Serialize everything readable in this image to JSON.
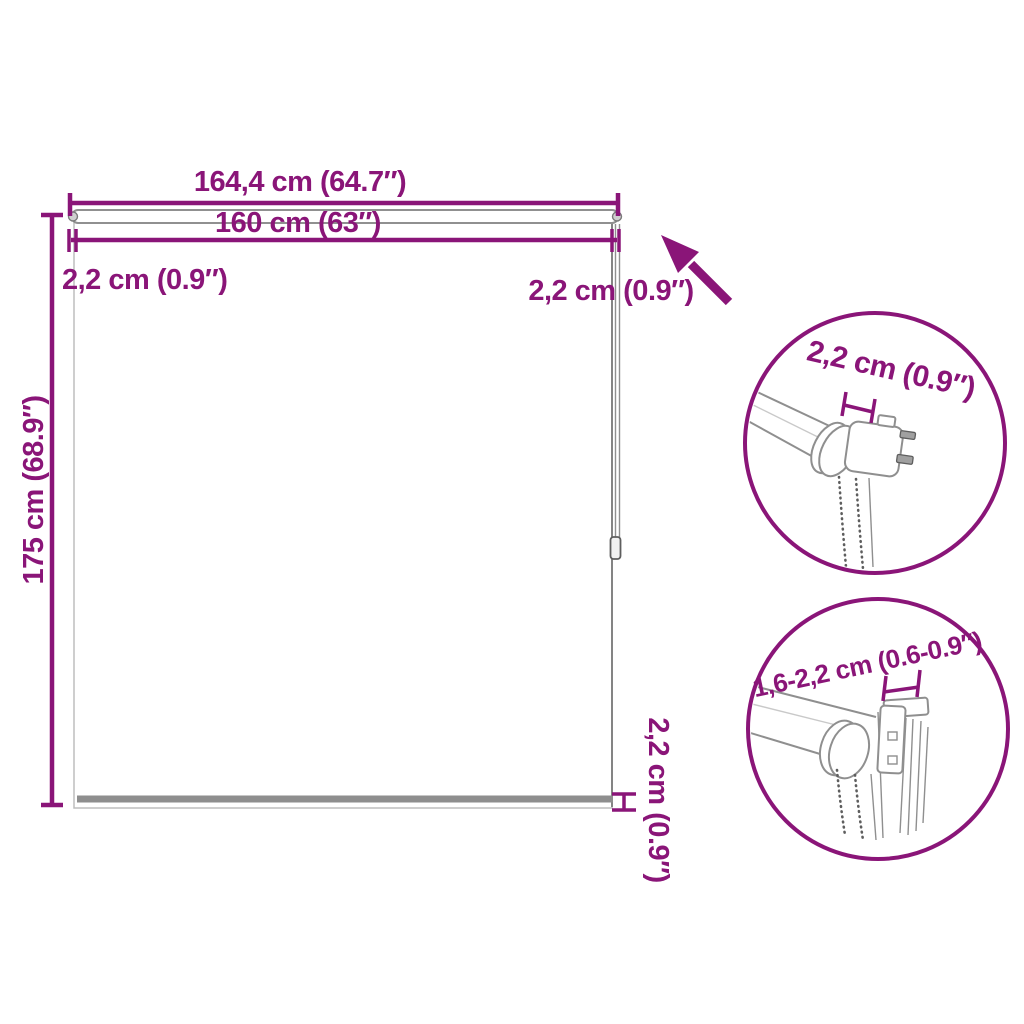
{
  "colors": {
    "accent": "#8A1578",
    "outline": "#8F8F8F",
    "outline_light": "#C9C9C9",
    "outline_dark": "#5E5E5E",
    "rail_fill": "#8E8E8E",
    "pin_fill": "#A0A0A0"
  },
  "labels": {
    "total_width": "164,4 cm (64.7″)",
    "fabric_width": "160 cm (63″)",
    "left_offset": "2,2 cm (0.9″)",
    "right_offset": "2,2 cm (0.9″)",
    "total_height": "175 cm (68.9″)",
    "bottom_bar": "2,2 cm (0.9″)",
    "bracket_depth": "2,2 cm (0.9″)",
    "clamp_range": "1,6-2,2 cm (0.6-0.9″)"
  }
}
